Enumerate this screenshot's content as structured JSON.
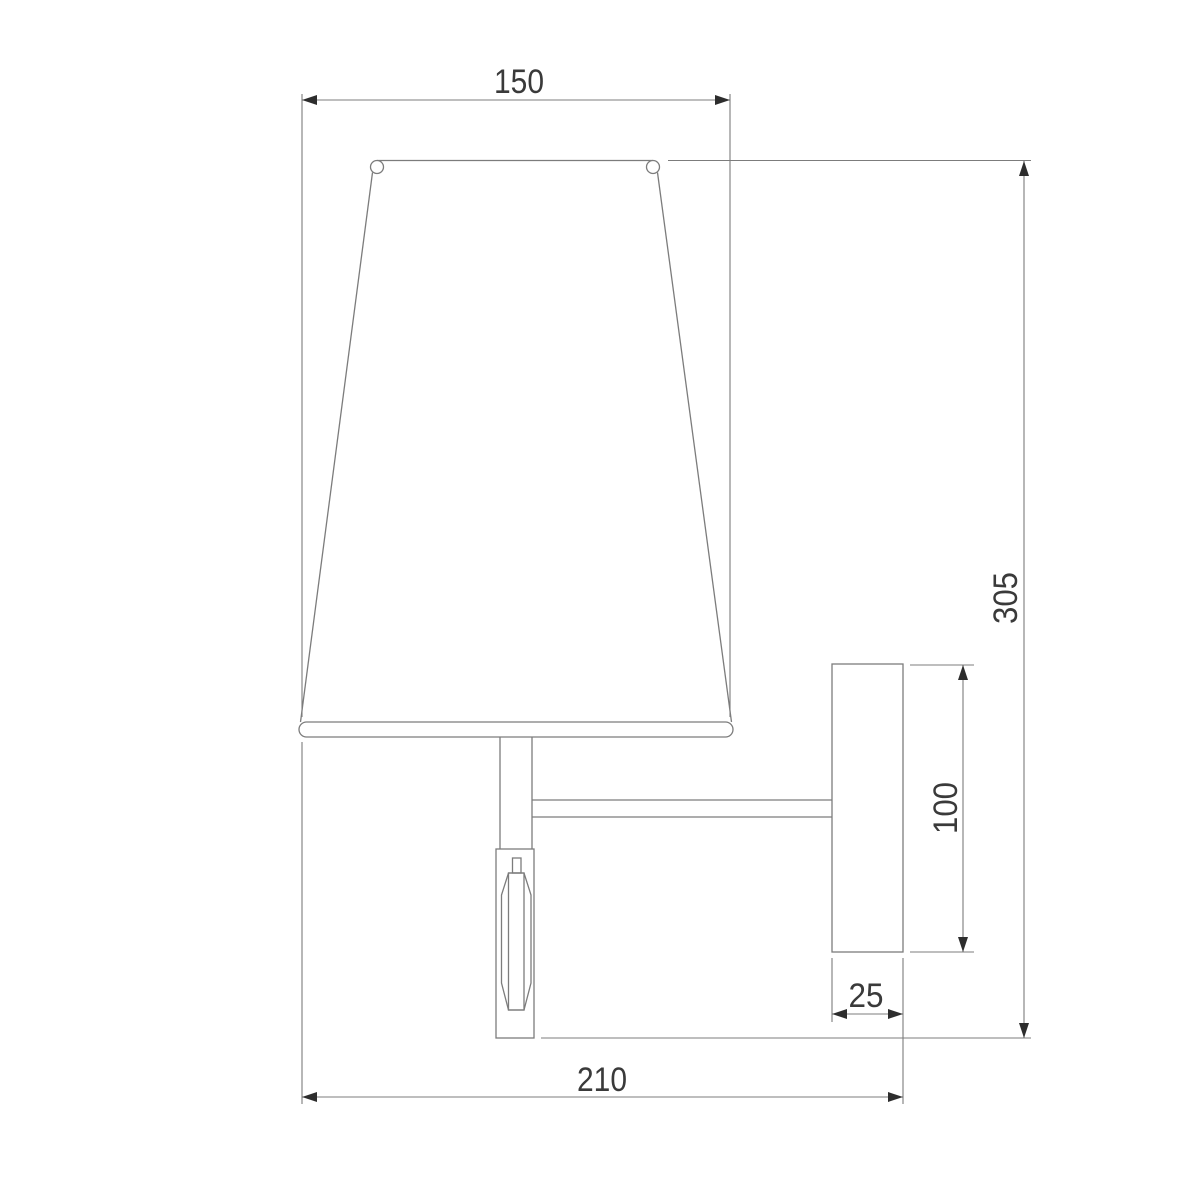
{
  "canvas": {
    "background": "#ffffff",
    "line_color": "#7c7c7c",
    "arrow_color": "#2d2d2d",
    "text_color": "#3a3a3a"
  },
  "drawing": {
    "subject": "wall-lamp-side-view",
    "dimensions": {
      "shade_width": {
        "label": "150"
      },
      "overall_height": {
        "label": "305"
      },
      "plate_height": {
        "label": "100"
      },
      "plate_depth": {
        "label": "25"
      },
      "overall_depth": {
        "label": "210"
      }
    }
  }
}
